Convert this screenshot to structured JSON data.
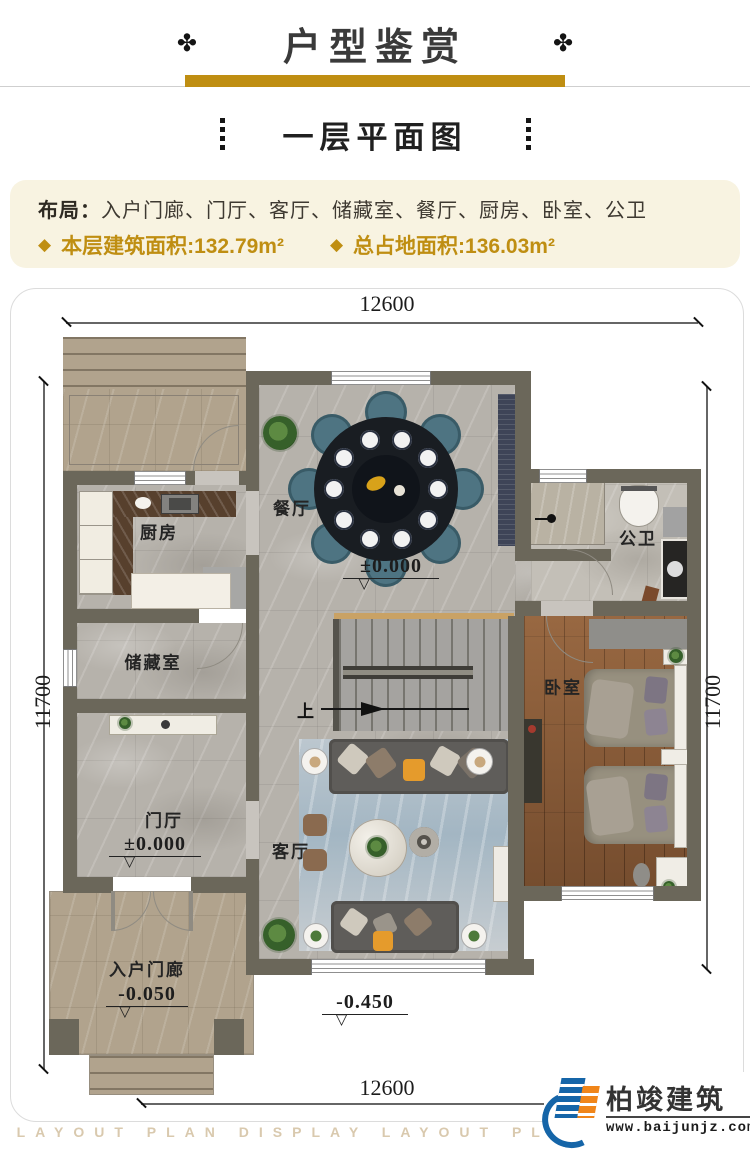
{
  "colors": {
    "gold": "#bf8e12",
    "cream": "#f8f3e1",
    "ink": "#3a3a3a",
    "text": "#3e3931",
    "wall": "#6b675a",
    "floor": "#b6b2ab",
    "floor-light": "#c3bfb7",
    "beige": "#b1a38d",
    "wood": "#8a5a36",
    "navy": "#3e4457",
    "teal": "#4e7482",
    "rug": "#a9bfca",
    "watermark": "#d9c9ae",
    "logo-blue": "#1565a8",
    "logo-orange": "#f08519"
  },
  "header": {
    "ornament": "✤",
    "title": "户型鉴赏"
  },
  "subtitle": {
    "text": "一层平面图"
  },
  "info": {
    "layout_label": "布局：",
    "layout_value": "入户门廊、门厅、客厅、储藏室、餐厅、厨房、卧室、公卫",
    "bullet": "◆",
    "stat1": "本层建筑面积:132.79m²",
    "stat2": "总占地面积:136.03m²"
  },
  "plan": {
    "dim_top": "12600",
    "dim_bottom": "12600",
    "dim_left": "11700",
    "dim_right": "11700",
    "rooms": {
      "dining": "餐厅",
      "kitchen": "厨房",
      "bath": "公卫",
      "storage": "储藏室",
      "bedroom": "卧室",
      "foyer": "门厅",
      "living": "客厅",
      "porch": "入户门廊"
    },
    "levels": {
      "dining": "±0.000",
      "foyer": "±0.000",
      "porch": "-0.050",
      "outdoor": "-0.450"
    },
    "stairs_up": "上"
  },
  "footer": {
    "watermark": "LAYOUT PLAN DISPLAY LAYOUT PLAN DISPLAY",
    "brand": "柏竣建筑",
    "site": "www.baijunjz.com"
  }
}
